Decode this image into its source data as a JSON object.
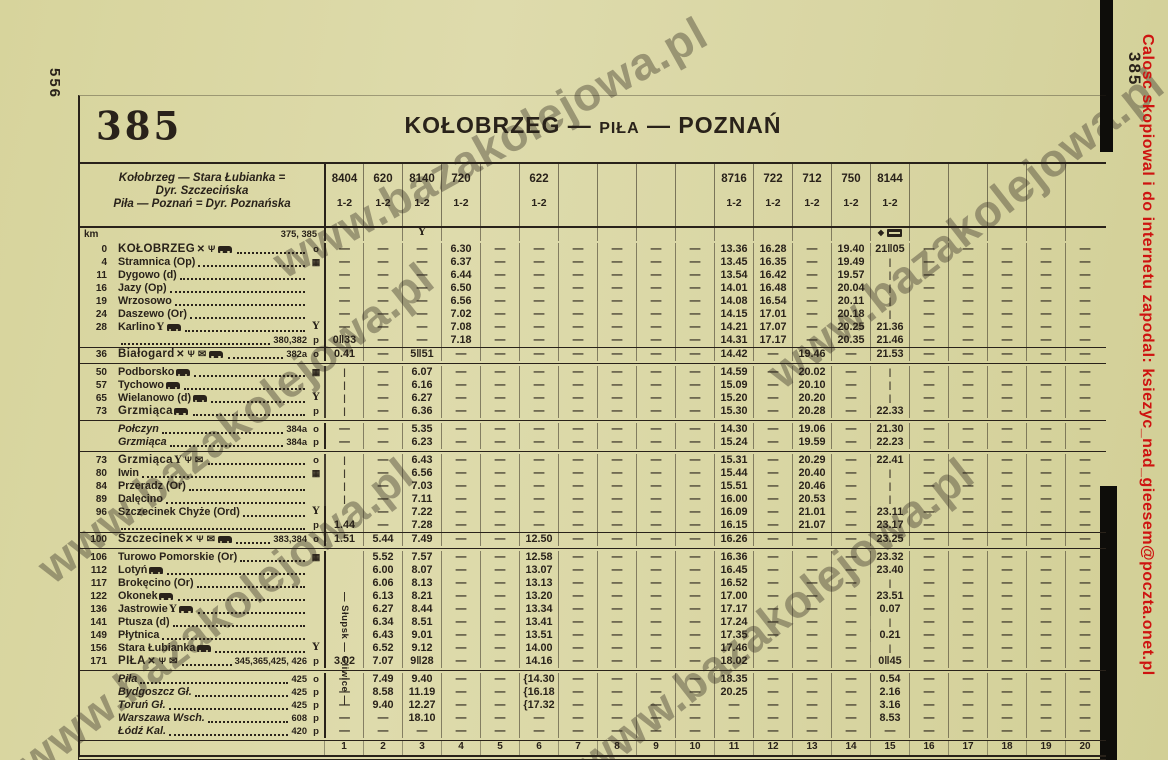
{
  "page": {
    "page_number_left": "556",
    "page_number_right": "385",
    "credit": "Calosc skopiowal i do internetu zapodal: ksiezyc_nad_gieesem@poczta.onet.pl",
    "watermark": "www.bazakolejowa.pl"
  },
  "colors": {
    "paper": "#d8d5a2",
    "ink": "#29221a",
    "credit_red": "#ce1310"
  },
  "header": {
    "table_number": "385",
    "title_left": "KOŁOBRZEG",
    "title_mid": "PIŁA",
    "title_right": "POZNAŃ",
    "route_info_line1": "Kołobrzeg — Stara Łubianka =",
    "route_info_line2": "Dyr. Szczecińska",
    "route_info_line3": "Piła — Poznań = Dyr. Poznańska"
  },
  "km_label": "km",
  "top_refs": "375, 385",
  "through_label": "Słupsk — Gliwice",
  "columns": [
    {
      "num": "1",
      "train": "8404",
      "cls": "1-2"
    },
    {
      "num": "2",
      "train": "620",
      "cls": "1-2"
    },
    {
      "num": "3",
      "train": "8140",
      "cls": "1-2"
    },
    {
      "num": "4",
      "train": "720",
      "cls": "1-2"
    },
    {
      "num": "5",
      "train": "",
      "cls": ""
    },
    {
      "num": "6",
      "train": "622",
      "cls": "1-2"
    },
    {
      "num": "7",
      "train": "",
      "cls": ""
    },
    {
      "num": "8",
      "train": "",
      "cls": ""
    },
    {
      "num": "9",
      "train": "",
      "cls": ""
    },
    {
      "num": "10",
      "train": "",
      "cls": ""
    },
    {
      "num": "11",
      "train": "8716",
      "cls": "1-2"
    },
    {
      "num": "12",
      "train": "722",
      "cls": "1-2"
    },
    {
      "num": "13",
      "train": "712",
      "cls": "1-2"
    },
    {
      "num": "14",
      "train": "750",
      "cls": "1-2"
    },
    {
      "num": "15",
      "train": "8144",
      "cls": "1-2"
    },
    {
      "num": "16",
      "train": "",
      "cls": ""
    },
    {
      "num": "17",
      "train": "",
      "cls": ""
    },
    {
      "num": "18",
      "train": "",
      "cls": ""
    },
    {
      "num": "19",
      "train": "",
      "cls": ""
    },
    {
      "num": "20",
      "train": "",
      "cls": ""
    }
  ],
  "column_icons": {
    "3": [
      "bar"
    ],
    "15": [
      "diamond",
      "couchette"
    ]
  },
  "sections": [
    {
      "rows": [
        {
          "km": "0",
          "name": "KOŁOBRZEG",
          "style": "big",
          "icons": [
            "restaurant",
            "buffet",
            "bus"
          ],
          "ref": "",
          "marker": "o",
          "cells": {
            "4": "6.30",
            "11": "13.36",
            "12": "16.28",
            "14": "19.40",
            "15": "21‖05"
          }
        },
        {
          "km": "4",
          "name": "Stramnica (Op)",
          "style": "",
          "icons": [],
          "ref": "",
          "marker": "flag",
          "cells": {
            "4": "6.37",
            "11": "13.45",
            "12": "16.35",
            "14": "19.49",
            "15": "|"
          }
        },
        {
          "km": "11",
          "name": "Dygowo (d)",
          "style": "",
          "icons": [],
          "ref": "",
          "marker": "",
          "cells": {
            "4": "6.44",
            "11": "13.54",
            "12": "16.42",
            "14": "19.57",
            "15": "|"
          }
        },
        {
          "km": "16",
          "name": "Jazy (Op)",
          "style": "",
          "icons": [],
          "ref": "",
          "marker": "",
          "cells": {
            "4": "6.50",
            "11": "14.01",
            "12": "16.48",
            "14": "20.04",
            "15": "|"
          }
        },
        {
          "km": "19",
          "name": "Wrzosowo",
          "style": "",
          "icons": [],
          "ref": "",
          "marker": "",
          "cells": {
            "4": "6.56",
            "11": "14.08",
            "12": "16.54",
            "14": "20.11",
            "15": "|"
          }
        },
        {
          "km": "24",
          "name": "Daszewo (Or)",
          "style": "",
          "icons": [],
          "ref": "",
          "marker": "",
          "cells": {
            "4": "7.02",
            "11": "14.15",
            "12": "17.01",
            "14": "20.18",
            "15": "|"
          }
        },
        {
          "km": "28",
          "name": "Karlino",
          "style": "",
          "icons": [
            "bar",
            "bus"
          ],
          "ref": "",
          "marker": "Y",
          "cells": {
            "4": "7.08",
            "11": "14.21",
            "12": "17.07",
            "14": "20.25",
            "15": "21.36"
          }
        },
        {
          "km": "",
          "name": "",
          "style": "",
          "icons": [],
          "ref": "380,382",
          "marker": "p",
          "cells": {
            "1": "0‖33",
            "4": "7.18",
            "11": "14.31",
            "12": "17.17",
            "14": "20.35",
            "15": "21.46"
          }
        },
        {
          "km": "36",
          "name": "Białogard",
          "style": "big rule",
          "icons": [
            "restaurant",
            "buffet",
            "post",
            "bus"
          ],
          "ref": "382a",
          "marker": "o",
          "cells": {
            "1": "0.41",
            "3": "5‖51",
            "11": "14.42",
            "13": "19.46",
            "15": "21.53"
          }
        }
      ]
    },
    {
      "rows": [
        {
          "km": "50",
          "name": "Podborsko",
          "style": "",
          "icons": [
            "bus"
          ],
          "ref": "",
          "marker": "flag",
          "cells": {
            "1": "|",
            "3": "6.07",
            "11": "14.59",
            "13": "20.02",
            "15": "|"
          }
        },
        {
          "km": "57",
          "name": "Tychowo",
          "style": "",
          "icons": [
            "bus"
          ],
          "ref": "",
          "marker": "",
          "cells": {
            "1": "|",
            "3": "6.16",
            "11": "15.09",
            "13": "20.10",
            "15": "|"
          }
        },
        {
          "km": "65",
          "name": "Wielanowo (d)",
          "style": "",
          "icons": [
            "bus"
          ],
          "ref": "",
          "marker": "Y",
          "cells": {
            "1": "|",
            "3": "6.27",
            "11": "15.20",
            "13": "20.20",
            "15": "|"
          }
        },
        {
          "km": "73",
          "name": "Grzmiąca",
          "style": "big",
          "icons": [
            "bus"
          ],
          "ref": "",
          "marker": "p",
          "cells": {
            "1": "|",
            "3": "6.36",
            "11": "15.30",
            "13": "20.28",
            "15": "22.33"
          }
        }
      ]
    },
    {
      "rows": [
        {
          "km": "",
          "name": "Połczyn",
          "style": "it",
          "icons": [],
          "ref": "384a",
          "marker": "o",
          "cells": {
            "3": "5.35",
            "11": "14.30",
            "13": "19.06",
            "15": "21.30"
          }
        },
        {
          "km": "",
          "name": "Grzmiąca",
          "style": "it",
          "icons": [],
          "ref": "384a",
          "marker": "p",
          "cells": {
            "3": "6.23",
            "11": "15.24",
            "13": "19.59",
            "15": "22.23"
          }
        }
      ]
    },
    {
      "rows": [
        {
          "km": "73",
          "name": "Grzmiąca",
          "style": "big",
          "icons": [
            "bar",
            "buffet",
            "post"
          ],
          "ref": "",
          "marker": "o",
          "cells": {
            "1": "|",
            "3": "6.43",
            "11": "15.31",
            "13": "20.29",
            "15": "22.41"
          }
        },
        {
          "km": "80",
          "name": "Iwin",
          "style": "",
          "icons": [],
          "ref": "",
          "marker": "flag",
          "cells": {
            "1": "|",
            "3": "6.56",
            "11": "15.44",
            "13": "20.40",
            "15": "|"
          }
        },
        {
          "km": "84",
          "name": "Przeradz (Or)",
          "style": "",
          "icons": [],
          "ref": "",
          "marker": "",
          "cells": {
            "1": "|",
            "3": "7.03",
            "11": "15.51",
            "13": "20.46",
            "15": "|"
          }
        },
        {
          "km": "89",
          "name": "Dalęcino",
          "style": "",
          "icons": [],
          "ref": "",
          "marker": "",
          "cells": {
            "1": "|",
            "3": "7.11",
            "11": "16.00",
            "13": "20.53",
            "15": "|"
          }
        },
        {
          "km": "96",
          "name": "Szczecinek Chyże (Ord)",
          "style": "",
          "icons": [],
          "ref": "",
          "marker": "Y",
          "cells": {
            "1": "",
            "3": "7.22",
            "11": "16.09",
            "13": "21.01",
            "15": "23.11"
          }
        },
        {
          "km": "",
          "name": "",
          "style": "",
          "icons": [],
          "ref": "",
          "marker": "p",
          "cells": {
            "1": "1.44",
            "3": "7.28",
            "11": "16.15",
            "13": "21.07",
            "15": "23.17"
          }
        },
        {
          "km": "100",
          "name": "Szczecinek",
          "style": "big rule",
          "icons": [
            "restaurant",
            "buffet",
            "post",
            "bus"
          ],
          "ref": "383,384",
          "marker": "o",
          "cells": {
            "1": "1.51",
            "2": "5.44",
            "3": "7.49",
            "6": "12.50",
            "11": "16.26",
            "15": "23.25"
          }
        }
      ]
    },
    {
      "rows": [
        {
          "km": "106",
          "name": "Turowo Pomorskie (Or)",
          "style": "",
          "icons": [],
          "ref": "",
          "marker": "flag",
          "cells": {
            "1": "",
            "2": "5.52",
            "3": "7.57",
            "6": "12.58",
            "11": "16.36",
            "15": "23.32"
          }
        },
        {
          "km": "112",
          "name": "Lotyń",
          "style": "",
          "icons": [
            "bus"
          ],
          "ref": "",
          "marker": "",
          "cells": {
            "1": "",
            "2": "6.00",
            "3": "8.07",
            "6": "13.07",
            "11": "16.45",
            "15": "23.40"
          }
        },
        {
          "km": "117",
          "name": "Brokęcino (Or)",
          "style": "",
          "icons": [],
          "ref": "",
          "marker": "",
          "cells": {
            "1": "",
            "2": "6.06",
            "3": "8.13",
            "6": "13.13",
            "11": "16.52",
            "15": "|"
          }
        },
        {
          "km": "122",
          "name": "Okonek",
          "style": "",
          "icons": [
            "bus"
          ],
          "ref": "",
          "marker": "",
          "cells": {
            "1": "",
            "2": "6.13",
            "3": "8.21",
            "6": "13.20",
            "11": "17.00",
            "15": "23.51"
          }
        },
        {
          "km": "136",
          "name": "Jastrowie",
          "style": "",
          "icons": [
            "bar",
            "bus"
          ],
          "ref": "",
          "marker": "",
          "cells": {
            "1": "",
            "2": "6.27",
            "3": "8.44",
            "6": "13.34",
            "11": "17.17",
            "15": "0.07"
          }
        },
        {
          "km": "141",
          "name": "Ptusza (d)",
          "style": "",
          "icons": [],
          "ref": "",
          "marker": "",
          "cells": {
            "1": "",
            "2": "6.34",
            "3": "8.51",
            "6": "13.41",
            "11": "17.24",
            "15": "|"
          }
        },
        {
          "km": "149",
          "name": "Płytnica",
          "style": "",
          "icons": [],
          "ref": "",
          "marker": "",
          "cells": {
            "1": "",
            "2": "6.43",
            "3": "9.01",
            "6": "13.51",
            "11": "17.35",
            "15": "0.21"
          }
        },
        {
          "km": "156",
          "name": "Stara Łubianka",
          "style": "",
          "icons": [
            "bus"
          ],
          "ref": "",
          "marker": "Y",
          "cells": {
            "1": "",
            "2": "6.52",
            "3": "9.12",
            "6": "14.00",
            "11": "17.46",
            "15": "|"
          }
        },
        {
          "km": "171",
          "name": "PIŁA",
          "style": "big",
          "icons": [
            "restaurant",
            "buffet",
            "post"
          ],
          "ref": "345,365,425, 426",
          "marker": "p",
          "cells": {
            "1": "3.02",
            "2": "7.07",
            "3": "9‖28",
            "6": "14.16",
            "11": "18.02",
            "15": "0‖45"
          }
        }
      ]
    },
    {
      "rows": [
        {
          "km": "",
          "name": "Piła",
          "style": "it",
          "icons": [],
          "ref": "425",
          "marker": "o",
          "cells": {
            "2": "7.49",
            "3": "9.40",
            "6": "{14.30",
            "11": "18.35",
            "15": "0.54"
          }
        },
        {
          "km": "",
          "name": "Bydgoszcz Gł.",
          "style": "it",
          "icons": [],
          "ref": "425",
          "marker": "p",
          "cells": {
            "2": "8.58",
            "3": "11.19",
            "6": "{16.18",
            "11": "20.25",
            "15": "2.16"
          }
        },
        {
          "km": "",
          "name": "Toruń Gł.",
          "style": "it",
          "icons": [],
          "ref": "425",
          "marker": "p",
          "cells": {
            "2": "9.40",
            "3": "12.27",
            "6": "{17.32",
            "15": "3.16"
          }
        },
        {
          "km": "",
          "name": "Warszawa Wsch.",
          "style": "it",
          "icons": [],
          "ref": "608",
          "marker": "p",
          "cells": {
            "3": "18.10",
            "15": "8.53"
          }
        },
        {
          "km": "",
          "name": "Łódź Kal.",
          "style": "it",
          "icons": [],
          "ref": "420",
          "marker": "p",
          "cells": {}
        }
      ]
    }
  ],
  "footer_numbers": [
    "1",
    "2",
    "3",
    "4",
    "5",
    "6",
    "7",
    "8",
    "9",
    "10",
    "11",
    "12",
    "13",
    "14",
    "15",
    "16",
    "17",
    "18",
    "19",
    "20"
  ]
}
